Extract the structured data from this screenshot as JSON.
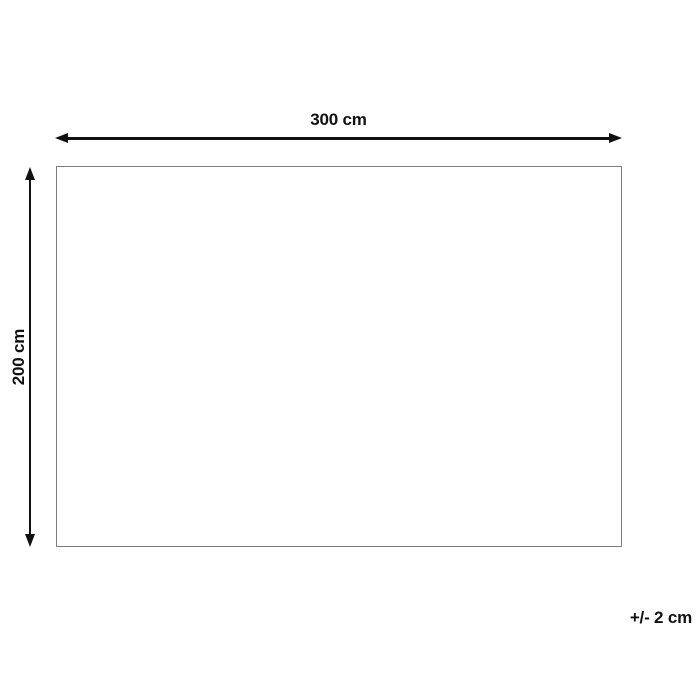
{
  "diagram": {
    "width_dimension": {
      "label": "300 cm"
    },
    "height_dimension": {
      "label": "200 cm"
    },
    "tolerance": {
      "label": "+/- 2 cm"
    }
  },
  "icons": {
    "arrowhead_left": "left-pointing solid triangle",
    "arrowhead_right": "right-pointing solid triangle",
    "arrowhead_up": "up-pointing solid triangle",
    "arrowhead_down": "down-pointing solid triangle"
  },
  "colors": {
    "arrow_color": "#111111",
    "text_color": "#111111",
    "rect_border_color": "#7e7e7e",
    "bg_color": "#ffffff"
  }
}
